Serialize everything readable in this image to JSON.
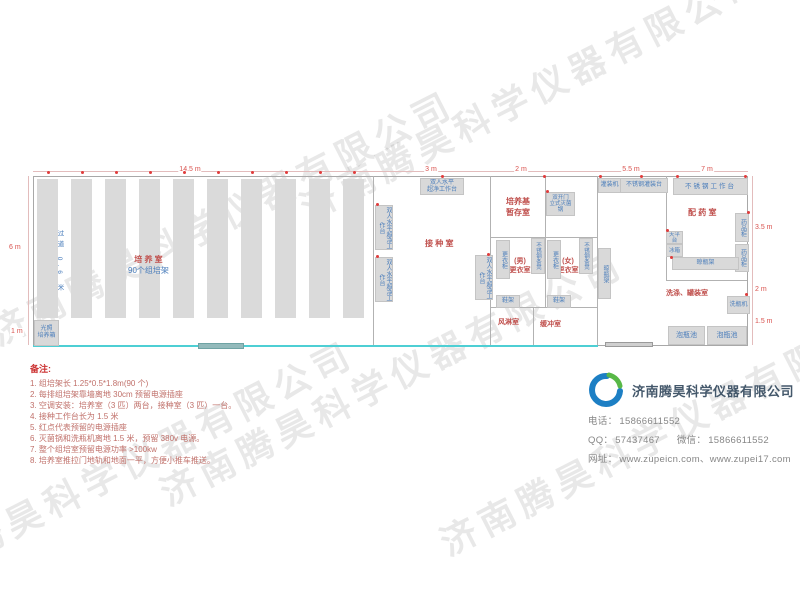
{
  "watermark": {
    "text": "济南腾昊科学仪器有限公司"
  },
  "plan": {
    "rack": {
      "count": 10,
      "x0": 37,
      "gap": 34,
      "width": 21,
      "top": 179,
      "height": 139
    },
    "outlets": [
      [
        47,
        171
      ],
      [
        81,
        171
      ],
      [
        115,
        171
      ],
      [
        149,
        171
      ],
      [
        183,
        171
      ],
      [
        217,
        171
      ],
      [
        251,
        171
      ],
      [
        285,
        171
      ],
      [
        319,
        171
      ],
      [
        353,
        171
      ],
      [
        441,
        175
      ],
      [
        376,
        203
      ],
      [
        376,
        255
      ],
      [
        487,
        253
      ],
      [
        546,
        190
      ],
      [
        543,
        175
      ],
      [
        599,
        175
      ],
      [
        640,
        175
      ],
      [
        676,
        175
      ],
      [
        744,
        175
      ],
      [
        747,
        211
      ],
      [
        666,
        229
      ],
      [
        670,
        256
      ],
      [
        745,
        293
      ]
    ],
    "dims": {
      "t1": "14.5 m",
      "t2": "3 m",
      "t3": "2 m",
      "t4": "5.5 m",
      "t5": "7 m",
      "l1": "6 m",
      "l2": "1 m",
      "r1": "3.5 m",
      "r2": "2 m",
      "r3": "1.5 m"
    },
    "rooms": {
      "culture": "培 养 室",
      "culture_sub": "90个组培架",
      "aisle": "过道 0.6 米",
      "inoculation": "接 种 室",
      "storage": "培养基\n暂存室",
      "men": "(男)\n更衣室",
      "women": "(女)\n更衣室",
      "air_shower": "风淋室",
      "buffer": "缓冲室",
      "prep": "配 药 室",
      "washing": "洗涤、罐装室"
    },
    "equipment": {
      "bench": "双人水平\n超净工作台",
      "bench_v": "双人水平超净工作台",
      "sterilizer": "双开门\n立式灭菌锅",
      "locker": "更衣柜",
      "steel_bench": "不锈钢条凳",
      "shoe_rack": "鞋架",
      "dry_rack": "晾瓶架",
      "filler": "灌装机",
      "fill_table": "不锈钢灌装台",
      "work_table": "不锈钢工作台",
      "med_cabinet": "药品柜",
      "balance": "天平台",
      "fridge": "冰箱",
      "washer": "洗瓶机",
      "pool": "泡瓶池",
      "incubator": "光照\n培养箱"
    }
  },
  "notes": {
    "title": "备注:",
    "items": [
      "1. 组培架长 1.25*0.5*1.8m(90 个)",
      "2. 每排组培架靠墙离地 30cm 预留电源插座",
      "3. 空调安装：培养室（3 匹）两台，接种室（3 匹）一台。",
      "4. 接种工作台长为 1.5 米",
      "5. 红点代表预留的电源插座",
      "6. 灭菌锅和洗瓶机离地 1.5 米，预留 380v 电源。",
      "7. 整个组培室预留电源功率 >100kw",
      "8. 培养室推拉门地轨和地面一平，方便小推车推送。"
    ]
  },
  "company": {
    "name": "济南腾昊科学仪器有限公司",
    "phone_label": "电话：",
    "phone": "15866611552",
    "qq_label": "QQ：",
    "qq": "57437467",
    "wechat_label": "微信：",
    "wechat": "15866611552",
    "site_label": "网址：",
    "sites": "www.zupeicn.com、www.zupei17.com"
  }
}
